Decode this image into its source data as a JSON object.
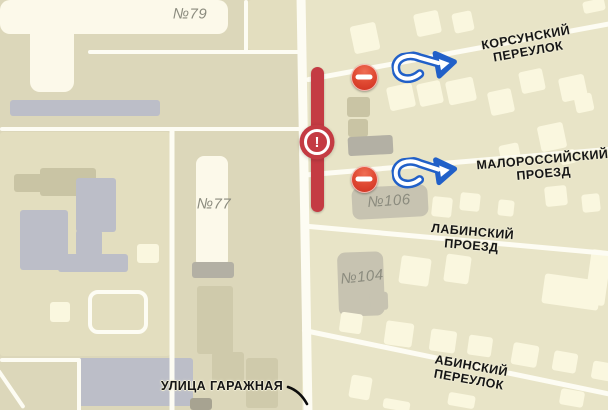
{
  "map": {
    "palette": {
      "block": "#e3debf",
      "cream": "#faf7df",
      "cream2": "#fcf9ea",
      "gray": "#bcbec8",
      "gray2": "#b3b0a4",
      "gray3": "#c7c3b1",
      "olive": "#c9c4a4",
      "olive2": "#cfcaab",
      "dark": "#a7a391",
      "road": "#fdfcf3",
      "closure_red": "#c43b43",
      "arrow_blue": "#2160c8",
      "no_entry_red": "#d6311f",
      "street_text": "#161616",
      "house_text": "#8b8b7e"
    },
    "streets": [
      {
        "name": "КОРСУНСКИЙ\nПЕРЕУЛОК",
        "x": 527,
        "y": 45,
        "r": -10,
        "fs": 12.5
      },
      {
        "name": "МАЛОРОССИЙСКИЙ\nПРОЕЗД",
        "x": 543,
        "y": 167,
        "r": -5,
        "fs": 12.5
      },
      {
        "name": "ЛАБИНСКИЙ ПРОЕЗД",
        "x": 472,
        "y": 239,
        "r": 5,
        "fs": 12.5
      },
      {
        "name": "АБИНСКИЙ ПЕРЕУЛОК",
        "x": 470,
        "y": 373,
        "r": 10,
        "fs": 12.5
      },
      {
        "name": "УЛИЦА ГАРАЖНАЯ",
        "x": 222,
        "y": 386,
        "r": 0,
        "fs": 12.5
      }
    ],
    "houses": [
      {
        "name": "№79",
        "x": 190,
        "y": 14,
        "r": 0,
        "fs": 15
      },
      {
        "name": "№77",
        "x": 214,
        "y": 204,
        "r": 0,
        "fs": 15
      },
      {
        "name": "№106",
        "x": 389,
        "y": 201,
        "r": -4,
        "fs": 15
      },
      {
        "name": "№104",
        "x": 362,
        "y": 277,
        "r": -6,
        "fs": 15
      }
    ],
    "roads": [
      {
        "x1": 301,
        "y1": -4,
        "x2": 308,
        "y2": 414,
        "w": 9
      },
      {
        "x1": 306,
        "y1": 80,
        "x2": 614,
        "y2": 23,
        "w": 5
      },
      {
        "x1": 306,
        "y1": 175,
        "x2": 614,
        "y2": 149,
        "w": 5
      },
      {
        "x1": 304,
        "y1": 226,
        "x2": 614,
        "y2": 254,
        "w": 5
      },
      {
        "x1": 302,
        "y1": 330,
        "x2": 614,
        "y2": 395,
        "w": 5
      },
      {
        "x1": 88,
        "y1": 52,
        "x2": 304,
        "y2": 52,
        "w": 4
      },
      {
        "x1": 246,
        "y1": 0,
        "x2": 246,
        "y2": 54,
        "w": 4
      },
      {
        "x1": 0,
        "y1": 129,
        "x2": 304,
        "y2": 129,
        "w": 4
      },
      {
        "x1": 172,
        "y1": 127,
        "x2": 172,
        "y2": 412,
        "w": 5
      },
      {
        "x1": 0,
        "y1": 360,
        "x2": 80,
        "y2": 360,
        "w": 4
      },
      {
        "x1": 79,
        "y1": 358,
        "x2": 79,
        "y2": 412,
        "w": 4
      },
      {
        "x1": -2,
        "y1": 370,
        "x2": 24,
        "y2": 408,
        "w": 4
      }
    ],
    "shapes": [
      {
        "x": 0,
        "y": 132,
        "w": 170,
        "h": 224,
        "c": "block"
      },
      {
        "x": 248,
        "y": 0,
        "w": 54,
        "h": 50,
        "c": "block"
      },
      {
        "x": 0,
        "y": 0,
        "w": 228,
        "h": 34,
        "c": "cream2",
        "br": 10
      },
      {
        "x": 30,
        "y": 0,
        "w": 44,
        "h": 92,
        "c": "cream2",
        "br": 10
      },
      {
        "x": 10,
        "y": 100,
        "w": 150,
        "h": 16,
        "c": "gray"
      },
      {
        "x": 40,
        "y": 168,
        "w": 56,
        "h": 28,
        "c": "olive"
      },
      {
        "x": 14,
        "y": 174,
        "w": 30,
        "h": 18,
        "c": "olive"
      },
      {
        "x": 76,
        "y": 178,
        "w": 40,
        "h": 54,
        "c": "gray"
      },
      {
        "x": 76,
        "y": 230,
        "w": 26,
        "h": 26,
        "c": "gray"
      },
      {
        "x": 58,
        "y": 254,
        "w": 70,
        "h": 18,
        "c": "gray"
      },
      {
        "x": 20,
        "y": 210,
        "w": 48,
        "h": 60,
        "c": "gray"
      },
      {
        "x": 137,
        "y": 244,
        "w": 22,
        "h": 19,
        "c": "cream"
      },
      {
        "x": 196,
        "y": 156,
        "w": 32,
        "h": 112,
        "c": "cream2",
        "br": 8
      },
      {
        "x": 192,
        "y": 262,
        "w": 42,
        "h": 16,
        "c": "gray2"
      },
      {
        "x": 50,
        "y": 302,
        "w": 20,
        "h": 20,
        "c": "cream"
      },
      {
        "x": 197,
        "y": 286,
        "w": 36,
        "h": 68,
        "c": "olive2"
      },
      {
        "x": 77,
        "y": 358,
        "w": 116,
        "h": 48,
        "c": "gray"
      },
      {
        "x": 246,
        "y": 358,
        "w": 32,
        "h": 50,
        "c": "olive2"
      },
      {
        "x": 212,
        "y": 352,
        "w": 32,
        "h": 30,
        "c": "olive2"
      },
      {
        "x": 190,
        "y": 398,
        "w": 22,
        "h": 12,
        "c": "dark"
      },
      {
        "x": 88,
        "y": 290,
        "w": 52,
        "h": 36,
        "type": "ring",
        "br": 10
      },
      {
        "x": 352,
        "y": 24,
        "w": 26,
        "h": 28,
        "r": -12,
        "c": "cream"
      },
      {
        "x": 415,
        "y": 12,
        "w": 25,
        "h": 23,
        "r": -12,
        "c": "cream"
      },
      {
        "x": 453,
        "y": 12,
        "w": 20,
        "h": 20,
        "r": -12,
        "c": "cream"
      },
      {
        "x": 520,
        "y": 70,
        "w": 24,
        "h": 22,
        "r": -12,
        "c": "cream"
      },
      {
        "x": 560,
        "y": 76,
        "w": 26,
        "h": 24,
        "r": -12,
        "c": "cream"
      },
      {
        "x": 583,
        "y": 0,
        "w": 22,
        "h": 12,
        "r": -12,
        "c": "cream"
      },
      {
        "x": 388,
        "y": 85,
        "w": 26,
        "h": 24,
        "r": -12,
        "c": "cream"
      },
      {
        "x": 418,
        "y": 82,
        "w": 24,
        "h": 23,
        "r": -12,
        "c": "cream"
      },
      {
        "x": 447,
        "y": 79,
        "w": 28,
        "h": 24,
        "r": -12,
        "c": "cream"
      },
      {
        "x": 489,
        "y": 90,
        "w": 24,
        "h": 24,
        "r": -12,
        "c": "cream"
      },
      {
        "x": 539,
        "y": 124,
        "w": 26,
        "h": 26,
        "r": -12,
        "c": "cream"
      },
      {
        "x": 575,
        "y": 94,
        "w": 18,
        "h": 18,
        "r": -12,
        "c": "cream"
      },
      {
        "x": 500,
        "y": 144,
        "w": 20,
        "h": 20,
        "r": -12,
        "c": "cream"
      },
      {
        "x": 560,
        "y": 150,
        "w": 16,
        "h": 14,
        "r": -12,
        "c": "cream"
      },
      {
        "x": 347,
        "y": 97,
        "w": 23,
        "h": 20,
        "c": "olive"
      },
      {
        "x": 348,
        "y": 119,
        "w": 20,
        "h": 18,
        "c": "olive"
      },
      {
        "x": 348,
        "y": 136,
        "w": 45,
        "h": 19,
        "r": -3,
        "c": "gray2"
      },
      {
        "x": 352,
        "y": 186,
        "w": 76,
        "h": 32,
        "r": -3,
        "c": "gray3",
        "br": 8
      },
      {
        "x": 432,
        "y": 197,
        "w": 20,
        "h": 20,
        "r": 6,
        "c": "cream"
      },
      {
        "x": 460,
        "y": 193,
        "w": 20,
        "h": 18,
        "r": 6,
        "c": "cream"
      },
      {
        "x": 498,
        "y": 200,
        "w": 16,
        "h": 16,
        "r": 6,
        "c": "cream"
      },
      {
        "x": 545,
        "y": 186,
        "w": 22,
        "h": 20,
        "r": -6,
        "c": "cream"
      },
      {
        "x": 582,
        "y": 194,
        "w": 18,
        "h": 18,
        "r": -6,
        "c": "cream"
      },
      {
        "x": 338,
        "y": 252,
        "w": 46,
        "h": 64,
        "r": -2,
        "c": "gray3",
        "br": 8
      },
      {
        "x": 370,
        "y": 292,
        "w": 18,
        "h": 18,
        "r": -2,
        "c": "gray3"
      },
      {
        "x": 400,
        "y": 257,
        "w": 30,
        "h": 28,
        "r": 8,
        "c": "cream"
      },
      {
        "x": 445,
        "y": 255,
        "w": 25,
        "h": 28,
        "r": 8,
        "c": "cream"
      },
      {
        "x": 543,
        "y": 277,
        "w": 57,
        "h": 30,
        "r": 8,
        "c": "cream"
      },
      {
        "x": 588,
        "y": 250,
        "w": 20,
        "h": 55,
        "r": 8,
        "c": "cream"
      },
      {
        "x": 340,
        "y": 313,
        "w": 22,
        "h": 20,
        "r": 8,
        "c": "cream"
      },
      {
        "x": 385,
        "y": 322,
        "w": 28,
        "h": 24,
        "r": 8,
        "c": "cream"
      },
      {
        "x": 430,
        "y": 330,
        "w": 26,
        "h": 22,
        "r": 8,
        "c": "cream"
      },
      {
        "x": 468,
        "y": 336,
        "w": 24,
        "h": 20,
        "r": 8,
        "c": "cream"
      },
      {
        "x": 512,
        "y": 344,
        "w": 26,
        "h": 22,
        "r": 10,
        "c": "cream"
      },
      {
        "x": 553,
        "y": 352,
        "w": 24,
        "h": 20,
        "r": 10,
        "c": "cream"
      },
      {
        "x": 592,
        "y": 362,
        "w": 20,
        "h": 18,
        "r": 10,
        "c": "cream"
      },
      {
        "x": 350,
        "y": 376,
        "w": 21,
        "h": 23,
        "r": 10,
        "c": "cream"
      },
      {
        "x": 383,
        "y": 400,
        "w": 27,
        "h": 10,
        "r": 10,
        "c": "cream"
      },
      {
        "x": 448,
        "y": 394,
        "w": 27,
        "h": 13,
        "r": 10,
        "c": "cream"
      },
      {
        "x": 560,
        "y": 390,
        "w": 24,
        "h": 16,
        "r": 10,
        "c": "cream"
      }
    ],
    "markers": {
      "closure": {
        "x": 317,
        "y1": 67,
        "y2": 212,
        "bar_w": 13,
        "badge_x": 317,
        "badge_y": 142,
        "symbol": "!"
      },
      "no_entry": [
        {
          "x": 364,
          "y": 77
        },
        {
          "x": 364,
          "y": 179
        }
      ],
      "arrows": [
        {
          "x": 392,
          "y": 50,
          "r": -8
        },
        {
          "x": 392,
          "y": 156,
          "r": -6
        }
      ]
    }
  }
}
